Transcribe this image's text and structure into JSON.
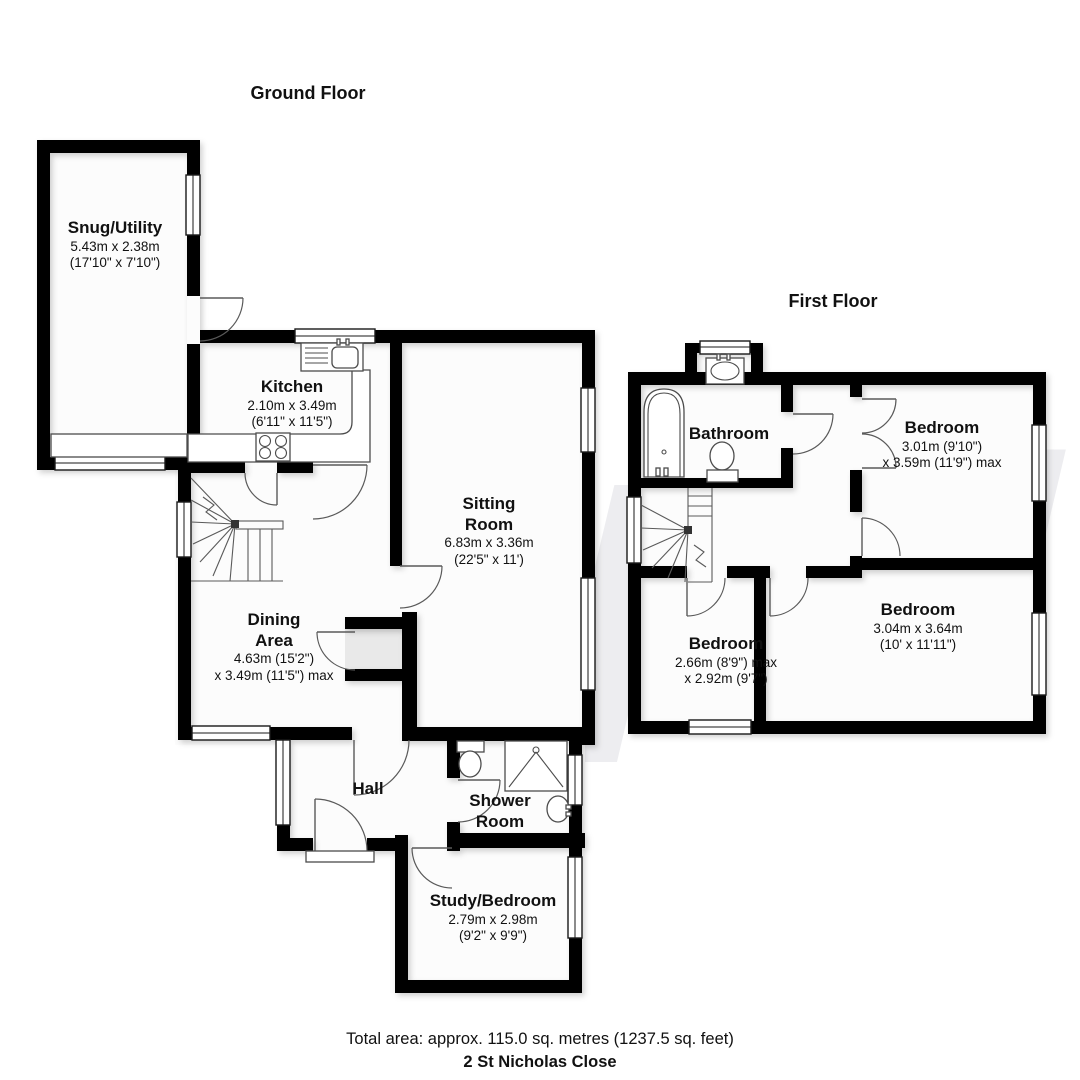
{
  "titles": {
    "ground": "Ground Floor",
    "first": "First Floor"
  },
  "watermark": {
    "letter": "W"
  },
  "rooms": {
    "snug": {
      "name": "Snug/Utility",
      "dims1": "5.43m x 2.38m",
      "dims2": "(17'10\" x 7'10\")"
    },
    "kitchen": {
      "name": "Kitchen",
      "dims1": "2.10m x 3.49m",
      "dims2": "(6'11\" x 11'5\")"
    },
    "sitting": {
      "name": "Sitting",
      "name2": "Room",
      "dims1": "6.83m x 3.36m",
      "dims2": "(22'5\" x 11')"
    },
    "dining": {
      "name": "Dining",
      "name2": "Area",
      "dims1": "4.63m (15'2\")",
      "dims2": "x 3.49m (11'5\") max"
    },
    "hall": {
      "name": "Hall"
    },
    "shower": {
      "name": "Shower",
      "name2": "Room"
    },
    "study": {
      "name": "Study/Bedroom",
      "dims1": "2.79m x 2.98m",
      "dims2": "(9'2\" x 9'9\")"
    },
    "bathroom": {
      "name": "Bathroom"
    },
    "bedroom_tr": {
      "name": "Bedroom",
      "dims1": "3.01m (9'10\")",
      "dims2": "x 3.59m (11'9\") max"
    },
    "bedroom_bl": {
      "name": "Bedroom",
      "dims1": "2.66m (8'9\") max",
      "dims2": "x 2.92m (9'7\")"
    },
    "bedroom_br": {
      "name": "Bedroom",
      "dims1": "3.04m x 3.64m",
      "dims2": "(10' x 11'11\")"
    }
  },
  "footer": {
    "total_area": "Total area: approx. 115.0 sq. metres (1237.5 sq. feet)",
    "address": "2 St Nicholas Close"
  }
}
